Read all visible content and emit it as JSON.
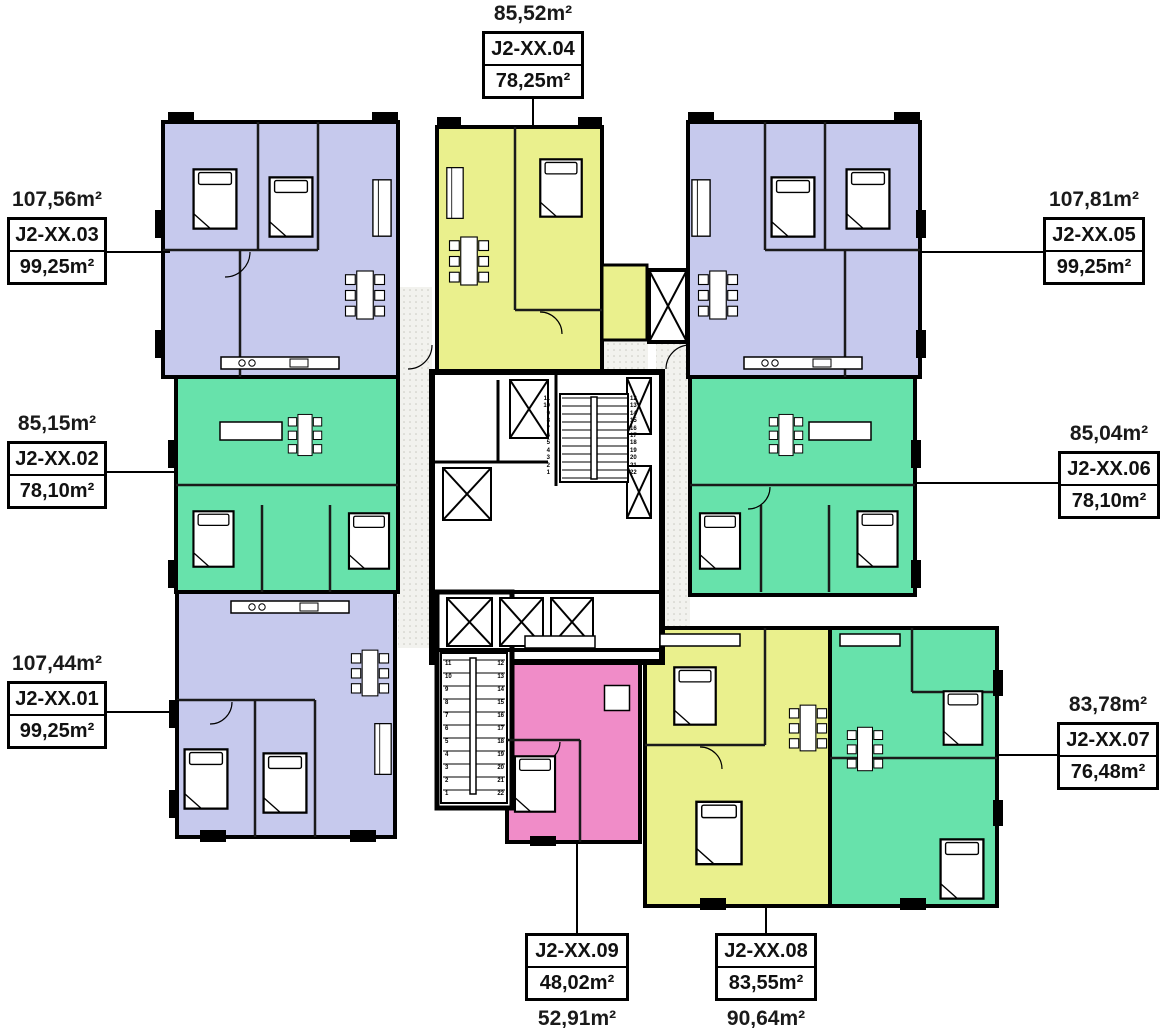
{
  "colors": {
    "unit_lavender": "#c6c9ed",
    "unit_lime": "#eaf08d",
    "unit_mint": "#67e2ab",
    "unit_pink": "#f08cc8",
    "wall": "#000000",
    "corridor_bg": "#f2f2ee"
  },
  "units": [
    {
      "name": "J2-XX.01",
      "area_inner": "99,25m²",
      "area_total": "107,44m²",
      "color": "lavender"
    },
    {
      "name": "J2-XX.02",
      "area_inner": "78,10m²",
      "area_total": "85,15m²",
      "color": "mint"
    },
    {
      "name": "J2-XX.03",
      "area_inner": "99,25m²",
      "area_total": "107,56m²",
      "color": "lavender"
    },
    {
      "name": "J2-XX.04",
      "area_inner": "78,25m²",
      "area_total": "85,52m²",
      "color": "lime"
    },
    {
      "name": "J2-XX.05",
      "area_inner": "99,25m²",
      "area_total": "107,81m²",
      "color": "lavender"
    },
    {
      "name": "J2-XX.06",
      "area_inner": "78,10m²",
      "area_total": "85,04m²",
      "color": "mint"
    },
    {
      "name": "J2-XX.07",
      "area_inner": "76,48m²",
      "area_total": "83,78m²",
      "color": "mint"
    },
    {
      "name": "J2-XX.08",
      "area_inner": "83,55m²",
      "area_total": "90,64m²",
      "color": "lime"
    },
    {
      "name": "J2-XX.09",
      "area_inner": "48,02m²",
      "area_total": "52,91m²",
      "color": "pink"
    }
  ],
  "stairs": {
    "upper_left_numbers": "11\n10\n9\n8\n7\n6\n5\n4\n3\n2\n1",
    "upper_right_numbers": "12\n13\n14\n15\n16\n17\n18\n19\n20\n21\n22",
    "lower_left_numbers": "11\n10\n9\n8\n7\n6\n5\n4\n3\n2\n1",
    "lower_right_numbers": "12\n13\n14\n15\n16\n17\n18\n19\n20\n21\n22"
  }
}
